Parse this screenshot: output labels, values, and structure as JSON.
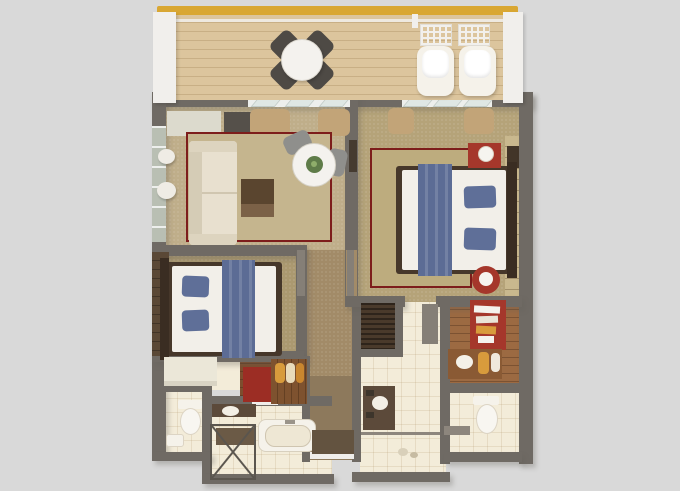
{
  "scene": {
    "title": "3D top-down floor plan render of a two-bedroom hotel suite with shared balcony",
    "canvas": {
      "width": 680,
      "height": 491
    },
    "visible_text": "none"
  },
  "palette": {
    "background": "#d9d9d9",
    "wall": "#6f6a64",
    "wall_light": "#857f77",
    "white_wall": "#f1efec",
    "railing_gold": "#d9a733",
    "deck_wood": "#dcc59d",
    "carpet_living": "#bfae8a",
    "carpet_bedroom_right": "#b5a379",
    "carpet_bedroom_left": "#ab9970",
    "carpet_hall": "#a28b68",
    "rug_inner_living": "#c5b58e",
    "rug_inner_bedroom": "#bdac7e",
    "rug_border_red": "#7d1d1b",
    "sofa_cream": "#e8e0cf",
    "table_white": "#f4f2ee",
    "chair_dark": "#4e4a45",
    "chair_gray": "#8f8f8c",
    "coffee_table": "#5a452f",
    "pouf_white": "#efece5",
    "bed_white": "#f2efe9",
    "bed_blue": "#5c6c95",
    "pillow_blue": "#5f6f98",
    "bed_frame_dark": "#46372a",
    "headboard_dark": "#3a2d22",
    "accent_red": "#a5372b",
    "bench_red": "#9c2d24",
    "lamp_white": "#f6f4ef",
    "tile_cream": "#f3ecd9",
    "wood_floor_dark": "#7d4e2e",
    "wood_dressing": "#9c6a42",
    "wood_rack": "#7e522f",
    "wardrobe_brown": "#4a3a2b",
    "entry_carpet": "#8d795c",
    "entry_mat": "#635340",
    "counter_dark": "#5c4a3a",
    "fixture_white": "#f5f2ea",
    "towel_yellow": "#d89b3c",
    "glass_green": "#b9bfb3",
    "curtain_tan": "#c2a478",
    "plant_green": "#5f7c49",
    "panel_wood": "#5a4836",
    "closet_tan": "#c9b88e"
  },
  "rooms": [
    {
      "id": "balcony",
      "furniture": [
        "round-patio-table",
        "patio-chair x4",
        "sun-lounger x2",
        "gold-railing"
      ]
    },
    {
      "id": "living-room",
      "furniture": [
        "sofa",
        "coffee-table",
        "round-dining-table",
        "dining-chair x2",
        "area-rug-red-border",
        "ottoman x2",
        "console x2",
        "curtains"
      ]
    },
    {
      "id": "bedroom-right",
      "furniture": [
        "double-bed",
        "blue-runner",
        "pillow x2",
        "red-nightstand",
        "table-lamp",
        "red-side-table",
        "area-rug-red-border",
        "closet-shelves",
        "curtains"
      ]
    },
    {
      "id": "bedroom-left",
      "furniture": [
        "double-bed",
        "blue-runner",
        "pillow x2",
        "desk",
        "red-bench",
        "luggage-rack",
        "wood-panel-wall"
      ]
    },
    {
      "id": "bathroom-left",
      "furniture": [
        "vanity",
        "shower-enclosure",
        "bathtub"
      ]
    },
    {
      "id": "toilet-left",
      "furniture": [
        "toilet",
        "sink"
      ]
    },
    {
      "id": "bathroom-right",
      "furniture": [
        "wardrobe-louvered",
        "vanity",
        "shower-floor"
      ]
    },
    {
      "id": "dressing-area",
      "furniture": [
        "red-accent-wall",
        "shelf-items",
        "wood-vanity",
        "sink",
        "towels"
      ]
    },
    {
      "id": "toilet-right",
      "furniture": [
        "toilet",
        "ledge"
      ]
    },
    {
      "id": "entry-hall",
      "furniture": [
        "door-mat",
        "entry-door"
      ]
    }
  ]
}
